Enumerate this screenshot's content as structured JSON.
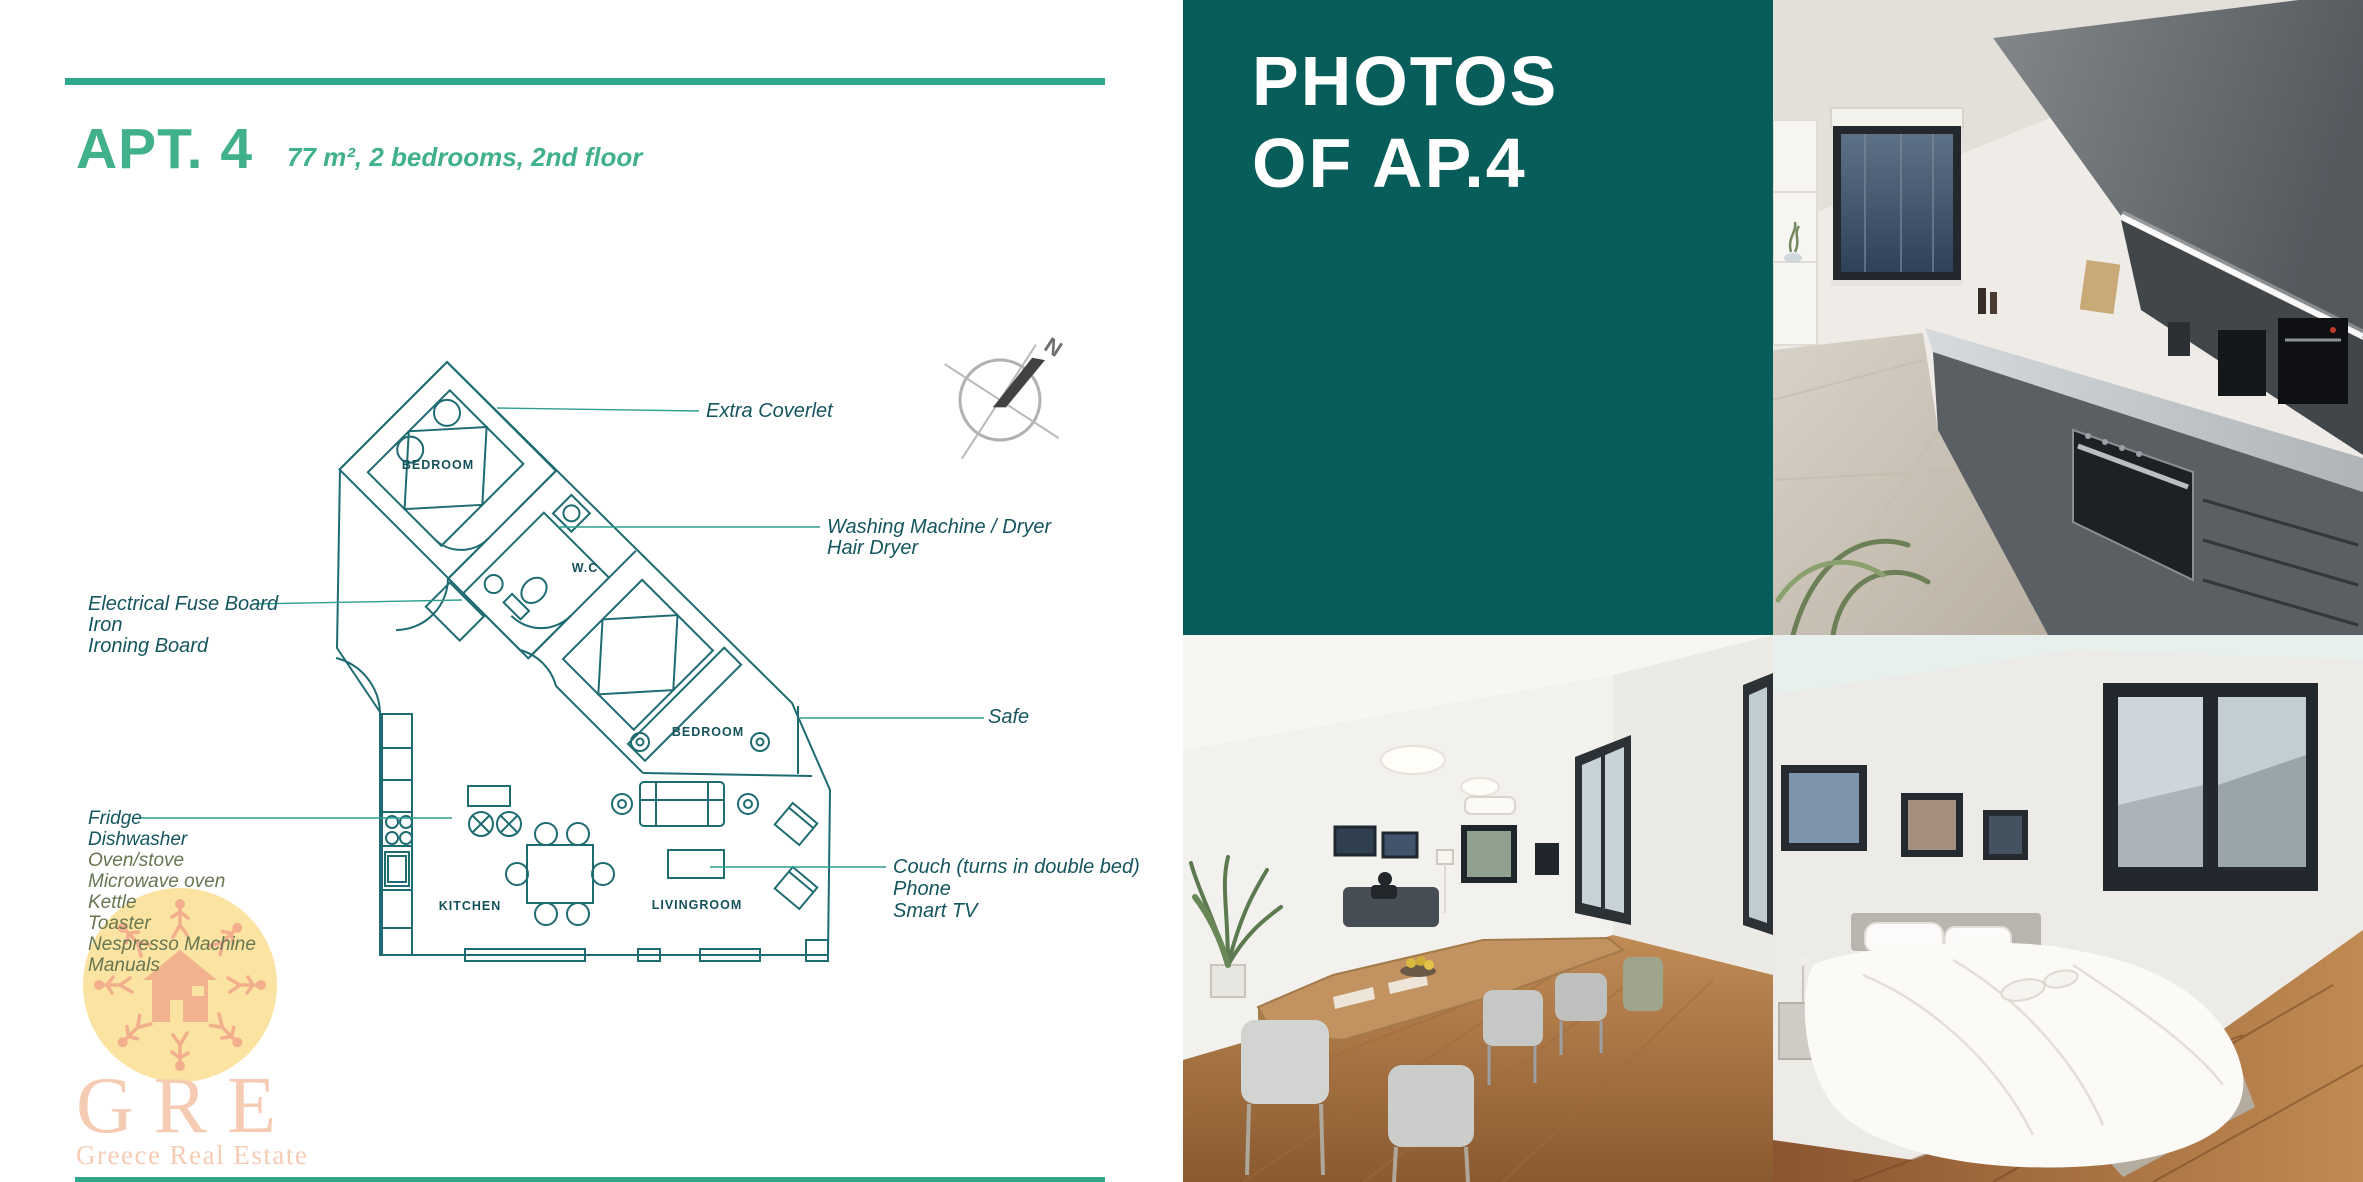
{
  "header": {
    "title": "APT. 4",
    "subtitle": "77 m², 2 bedrooms, 2nd floor"
  },
  "photos_panel": {
    "line1": "PHOTOS",
    "line2": "OF AP.4"
  },
  "floor_plan": {
    "compass": "N",
    "rooms": {
      "bedroom1": "BEDROOM",
      "wc": "W.C",
      "bedroom2": "BEDROOM",
      "kitchen": "KITCHEN",
      "livingroom": "LIVINGROOM"
    },
    "annotations": {
      "extra_coverlet": "Extra Coverlet",
      "washing": [
        "Washing Machine / Dryer",
        "Hair Dryer"
      ],
      "fuse": [
        "Electrical Fuse Board",
        "Iron",
        "Ironing Board"
      ],
      "safe": "Safe",
      "kitchen_items": [
        "Fridge",
        "Dishwasher",
        "Oven/stove",
        "Microwave oven",
        "Kettle",
        "Toaster",
        "Nespresso Machine",
        "Manuals"
      ],
      "couch": [
        "Couch (turns in double bed)",
        "Phone",
        "Smart TV"
      ]
    }
  },
  "logo": {
    "acronym": "GRE",
    "name": "Greece Real Estate"
  },
  "colors": {
    "accent_green": "#40b08d",
    "panel_teal": "#075d5a",
    "plan_ink": "#1e6b72",
    "annotation_ink": "#14555e",
    "leader_line": "#2f9f90",
    "logo_salmon": "#f3b393"
  }
}
